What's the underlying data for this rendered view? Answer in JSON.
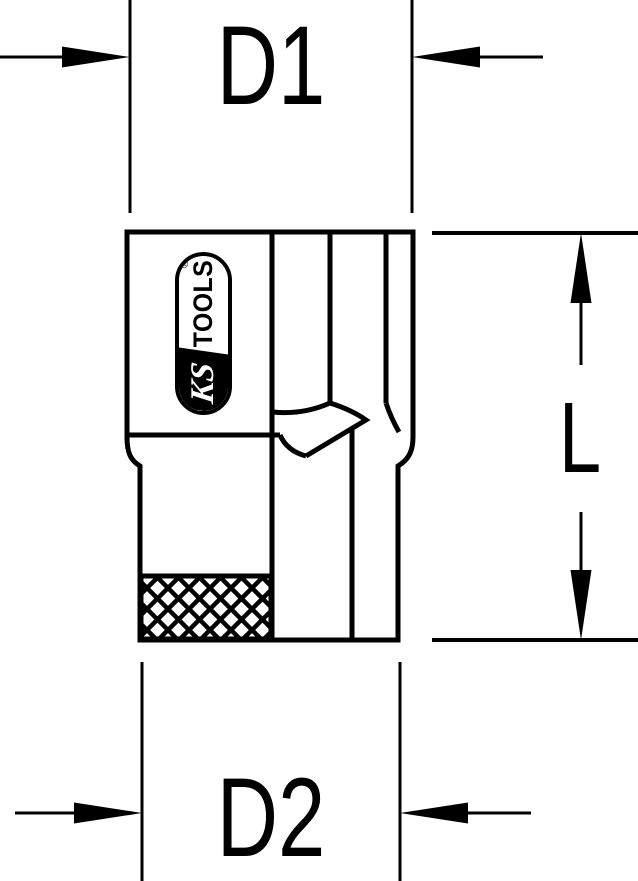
{
  "drawing": {
    "background_color": "#ffffff",
    "line_color": "#000000",
    "subject": "socket side view with dimension callouts"
  },
  "dimensions": {
    "d1": {
      "label": "D1"
    },
    "d2": {
      "label": "D2"
    },
    "length": {
      "label": "L"
    }
  },
  "logo": {
    "brand_script": "KS",
    "brand_word": "TOOLS",
    "registered_mark": "®"
  }
}
